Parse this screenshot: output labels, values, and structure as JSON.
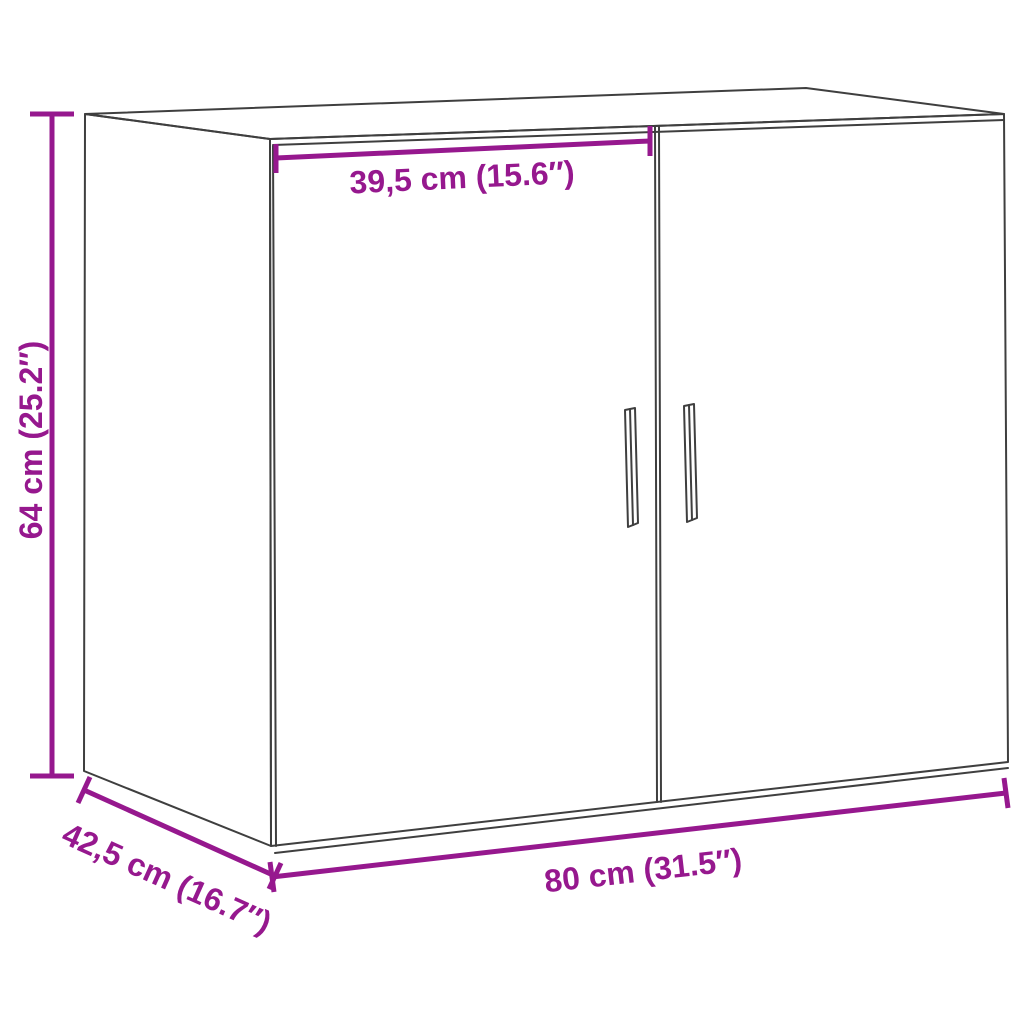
{
  "diagram": {
    "colors": {
      "dimension": "#96188E",
      "outline": "#3F3F3F",
      "background": "#FFFFFF"
    },
    "dimensions": {
      "door_width": {
        "label": "39,5 cm (15.6″)",
        "cm": 39.5,
        "inches": 15.6
      },
      "height": {
        "label": "64 cm (25.2″)",
        "cm": 64,
        "inches": 25.2
      },
      "depth": {
        "label": "42,5 cm (16.7″)",
        "cm": 42.5,
        "inches": 16.7
      },
      "width": {
        "label": "80 cm (31.5″)",
        "cm": 80,
        "inches": 31.5
      }
    }
  }
}
